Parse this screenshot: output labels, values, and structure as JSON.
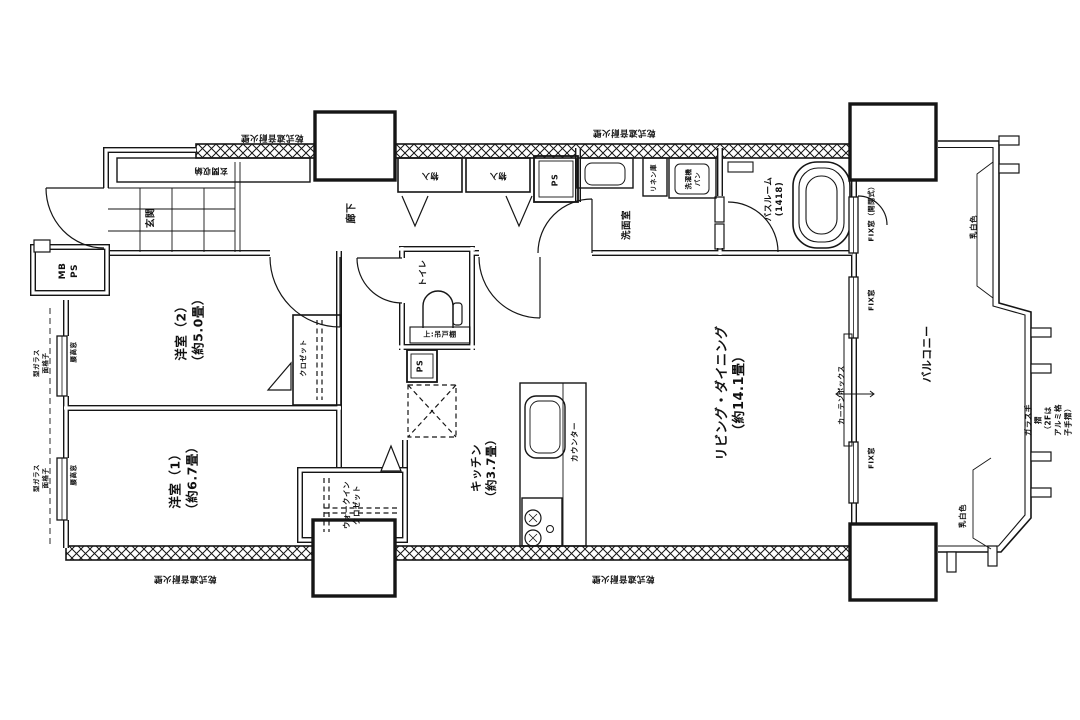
{
  "labels": {
    "fire_wall": "乾式遮音耐火壁",
    "entrance_storage": "玄関収納",
    "entrance": "玄関",
    "meter_pipe_space": "MB\nPS",
    "hallway": "廊下",
    "storage": "物入",
    "pipe_space": "PS",
    "washroom": "洗面室",
    "linen_cabinet": "リネン庫",
    "washer_pan": "洗濯機\nパン",
    "bathroom_name": "バスルーム",
    "bathroom_size": "(1418)",
    "toilet": "トイレ",
    "upper_cabinet": "上:吊戸棚",
    "bedroom2_name": "洋室（2）",
    "bedroom2_size": "（約5.0畳）",
    "closet": "クロゼット",
    "bedroom1_name": "洋室（1）",
    "bedroom1_size": "（約6.7畳）",
    "wic": "ウォークイン\nクロゼット",
    "kitchen_name": "キッチン",
    "kitchen_size": "（約3.7畳）",
    "counter": "カウンター",
    "living_name": "リビング・ダイニング",
    "living_size": "（約14.1畳）",
    "curtain_box": "カーテンボックス",
    "fix_window_openable": "FIX窓（開閉式）",
    "fix_window": "FIX窓",
    "balcony": "バルコニー",
    "frosted": "乳白色",
    "glass_rail": "ガラス手摺\n（2Fはアルミ格子手摺）",
    "patterned_glass_grille": "型ガラス\n面格子",
    "waist_window": "腰高窓"
  },
  "colors": {
    "line": "#151515",
    "background": "#ffffff"
  }
}
